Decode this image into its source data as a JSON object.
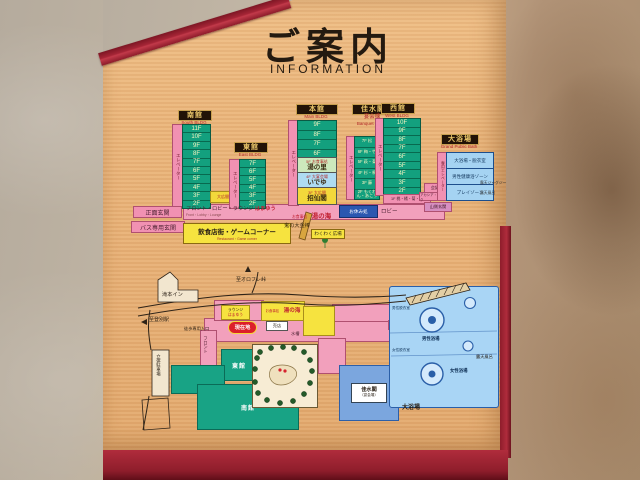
{
  "title": {
    "jp": "ご案内",
    "en": "INFORMATION"
  },
  "guide": {
    "south": {
      "name": "南館",
      "en": "South BLDG",
      "elevator": "エレベーター",
      "hall": "大広間",
      "floors": [
        "11F",
        "10F",
        "9F",
        "8F",
        "7F",
        "6F",
        "5F",
        "4F",
        "3F",
        "2F"
      ]
    },
    "east": {
      "name": "東館",
      "en": "East BLDG",
      "elevator": "エレベーター",
      "floors": [
        "7F",
        "6F",
        "5F",
        "4F",
        "3F",
        "2F"
      ]
    },
    "main": {
      "name": "本館",
      "en": "Main BLDG",
      "elevator": "エレベーター",
      "upper": [
        "9F",
        "8F",
        "7F",
        "6F"
      ],
      "f5_label": "5F",
      "f5_prefix": "お食事処",
      "f5_name": "湯の里",
      "f4_label": "4F",
      "f4_prefix": "大宴会場",
      "f4_name": "いでゆ",
      "f3_label": "3F",
      "f3_prefix": "大広間",
      "f3_name": "招仙閣"
    },
    "banquet": {
      "name": "佳水閣",
      "jp": "宴会棟",
      "en": "Banquet BLDG",
      "elevator": "エレベーター",
      "floors": [
        "7F 松",
        "6F 梅・竹",
        "5F 萩・菊",
        "4F 杉・桐",
        "3F 藤",
        "2F もくれん・あこう"
      ]
    },
    "west": {
      "name": "西館",
      "en": "West BLDG",
      "elevator": "エレベーター",
      "floors": [
        "10F",
        "9F",
        "8F",
        "7F",
        "6F",
        "5F",
        "4F",
        "3F",
        "2F"
      ],
      "f1": "1F 桃・橘・菊・梅",
      "meeting": "会議室",
      "meeting_rooms": "アカシア・ライラック",
      "side_entrance": "山側玄関"
    },
    "bath": {
      "name": "大浴場",
      "en": "Grand Public Bath",
      "elevator": "専用エレベーター",
      "rooms": [
        "大浴場・脱衣室",
        "男性健康浴ゾーン",
        "プレイゾーン"
      ],
      "note_jacuzzi": "露天ジャグジー",
      "note_rotenburo": "露天風呂"
    },
    "band": {
      "front": "フロント・ロビー・ラウンジ",
      "front_name": "はまゆう",
      "front_en": "Front・Lobby・Lounge",
      "dining_prefix": "お食事処",
      "dining_name": "湯の海",
      "rest": "お休み処",
      "lobby": "ロビー"
    },
    "rows": {
      "restaurants": "飲食店街・ゲームコーナー",
      "restaurants_en": "Restaurant・Game corner",
      "club": "鬼の大金棒",
      "plaza": "わくわく広場"
    },
    "entrances": {
      "main": "正面玄関",
      "bus": "バス専用玄関"
    }
  },
  "map": {
    "to_orofure": "至オロフレ峠",
    "to_station": "至登別駅",
    "takimoto_inn": "滝本イン",
    "walk_entrance": "徒歩専用入口",
    "parking": "立体駐車場",
    "front": "フロント",
    "lounge1": "ラウンジ",
    "lounge2": "はまゆう",
    "you_are_here": "現在地",
    "dining_prefix": "お食事処",
    "dining_name": "湯の海",
    "shop": "売店",
    "aquarium": "水槽",
    "east": "東館",
    "south": "南館",
    "west": "西館",
    "kasui": "佳水閣",
    "kasui_sub": "（宴会場）",
    "bath_label": "大浴場",
    "rotenburo": "露天風呂",
    "mens_bath": "男性浴場",
    "womens_bath": "女性浴場",
    "mens_locker": "男性脱衣室",
    "womens_locker": "女性脱衣室"
  },
  "colors": {
    "accent_red": "#a52536",
    "pink": "#f191b2",
    "green": "#13a07e",
    "yellow": "#f6e33f",
    "blue": "#a5d3f2",
    "wood": "#e9b47a"
  }
}
